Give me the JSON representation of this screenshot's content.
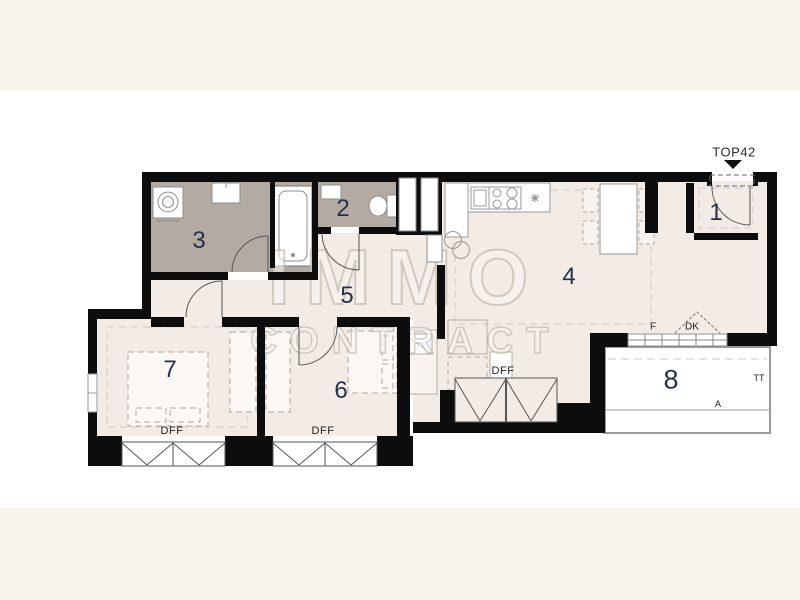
{
  "unit": {
    "label": "TOP42"
  },
  "watermark": {
    "line1": "IMMO",
    "line2": "CONTRACT"
  },
  "rooms": {
    "r1": "1",
    "r2": "2",
    "r3": "3",
    "r4": "4",
    "r5": "5",
    "r6": "6",
    "r7": "7",
    "r8": "8"
  },
  "labels": {
    "dff1": "DFF",
    "dff2": "DFF",
    "dff3": "DFF",
    "window_f": "F",
    "door_dk": "DK",
    "tt": "TT",
    "a": "A"
  },
  "colors": {
    "background_band": "#f8f5ee",
    "canvas": "#ffffff",
    "floor": "#f3ebe6",
    "wet_room_floor": "#b3aaa3",
    "wall": "#0d0d0d",
    "room_number": "#26304a",
    "annotation": "#222222"
  }
}
